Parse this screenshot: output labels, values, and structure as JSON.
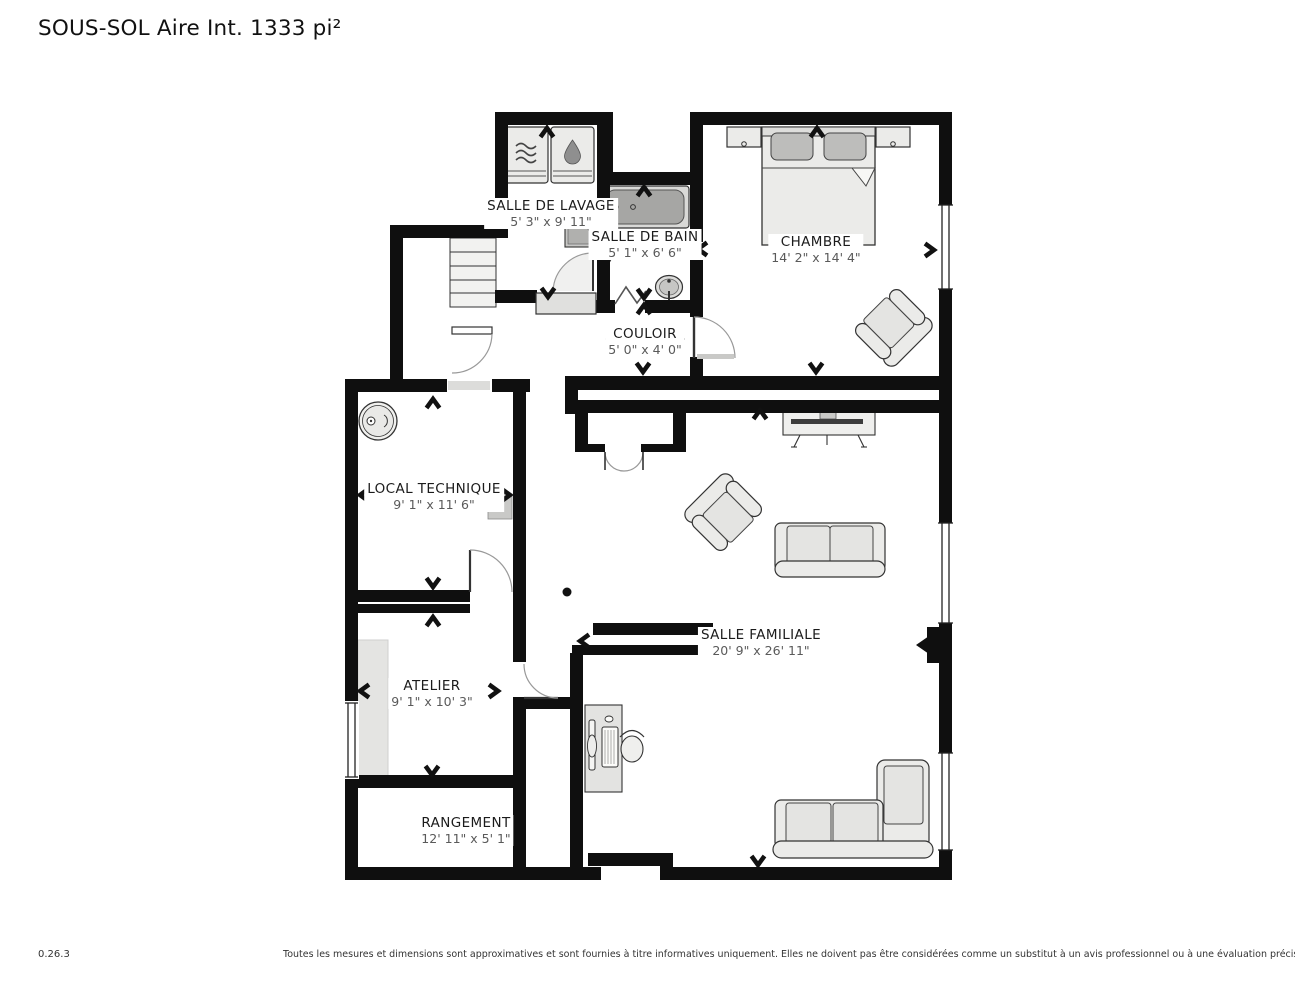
{
  "title": "SOUS-SOL Aire Int. 1333 pi²",
  "rooms": [
    {
      "id": "salle-de-lavage",
      "name": "SALLE DE LAVAGE",
      "dims": "5' 3\" x 9' 11\""
    },
    {
      "id": "salle-de-bain",
      "name": "SALLE DE BAIN",
      "dims": "5' 1\" x 6' 6\""
    },
    {
      "id": "chambre",
      "name": "CHAMBRE",
      "dims": "14' 2\" x 14' 4\""
    },
    {
      "id": "couloir",
      "name": "COULOIR",
      "dims": "5' 0\" x 4' 0\""
    },
    {
      "id": "local-technique",
      "name": "LOCAL TECHNIQUE",
      "dims": "9' 1\" x 11' 6\""
    },
    {
      "id": "atelier",
      "name": "ATELIER",
      "dims": "9' 1\" x 10' 3\""
    },
    {
      "id": "rangement",
      "name": "RANGEMENT",
      "dims": "12' 11\" x 5' 1\""
    },
    {
      "id": "salle-familiale",
      "name": "SALLE FAMILIALE",
      "dims": "20' 9\" x 26' 11\""
    }
  ],
  "footer": {
    "version": "0.26.3",
    "disclaimer": "Toutes les mesures et dimensions sont approximatives et sont fournies à titre informatives uniquement. Elles ne doivent pas être considérées comme un substitut à un avis professionnel ou à une évaluation précise."
  },
  "colors": {
    "wall": "#0f0f0f",
    "furniture_fill": "#ebebe9",
    "dim_text": "#5a5a5a"
  },
  "furniture_icons": [
    "washer-icon",
    "dryer-icon",
    "laundry-sink-icon",
    "bathtub-icon",
    "bathroom-sink-icon",
    "toilet-icon",
    "staircase-icon",
    "double-bed-icon",
    "nightstand-icon",
    "armchair-icon",
    "tv-console-icon",
    "tv-icon",
    "loveseat-icon",
    "sectional-sofa-icon",
    "desk-icon",
    "computer-icon",
    "office-chair-icon",
    "water-heater-icon",
    "electrical-panel-icon",
    "workbench-icon",
    "support-post-icon",
    "chimney-icon"
  ]
}
